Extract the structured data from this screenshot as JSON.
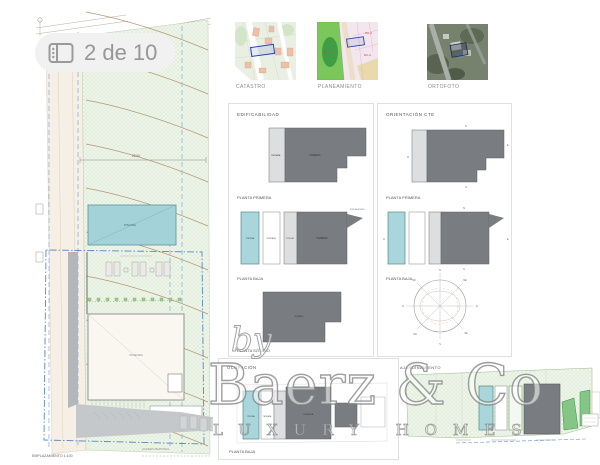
{
  "badge": {
    "label": "2 de 10"
  },
  "maps": {
    "catastro": "CATASTRO",
    "planeamiento": "PLANEAMIENTO",
    "ortofoto": "ORTOFOTO",
    "plan_codes": {
      "ru2": "RU-2",
      "rlp": "RL-P"
    }
  },
  "site_plan": {
    "title": "EMPLAZAMIENTO 1:100",
    "pool": "PISCINA",
    "house": "VIVIENDA",
    "roof_note_1": "CUBIERTA NO",
    "roof_note_2": "TRANSITABLE",
    "access_note": "ACCESO PEATONAL",
    "dimension": "22.00"
  },
  "edificabilidad": {
    "header": "EDIFICABILIDAD",
    "plans": [
      {
        "label": "PLANTA PRIMERA",
        "rooms": {
          "terraza": "TERRAZA",
          "vivienda": "VIVIENDA"
        }
      },
      {
        "label": "PLANTA BAJA",
        "rooms": {
          "piscina": "PISCINA",
          "terraza": "TERRAZA",
          "porche": "PORCHE",
          "vivienda": "VIVIENDA",
          "acceso": "PORCHE ACCESO"
        }
      },
      {
        "label": "PLANTA SÓTANO",
        "rooms": {
          "sotano": "SÓTANO"
        }
      }
    ]
  },
  "orientacion": {
    "header": "ORIENTACIÓN CTE",
    "plans": [
      {
        "label": "PLANTA PRIMERA"
      },
      {
        "label": "PLANTA BAJA"
      }
    ],
    "compass": {
      "n": "N",
      "ne": "NE",
      "e": "E",
      "se": "SE",
      "s": "S",
      "so": "SO",
      "o": "O",
      "no": "NO"
    }
  },
  "ocupacion": {
    "header": "OCUPACIÓN",
    "label": "PLANTA BAJA",
    "rooms": {
      "piscina": "PISCINA",
      "terraza": "TERRAZA",
      "vivienda": "VIVIENDA"
    }
  },
  "ajardinamiento": {
    "header": "AJARDINAMIENTO"
  },
  "watermark": {
    "by": "by",
    "brand": "Baerz & Co",
    "tagline": "LUXURY HOMES"
  },
  "colors": {
    "pool": "#a3d2d8",
    "building_gray": "#797d81",
    "plot_green": "#eef5e9",
    "contour_brown": "#a8855f",
    "alignment_blue": "#5b86c4"
  }
}
